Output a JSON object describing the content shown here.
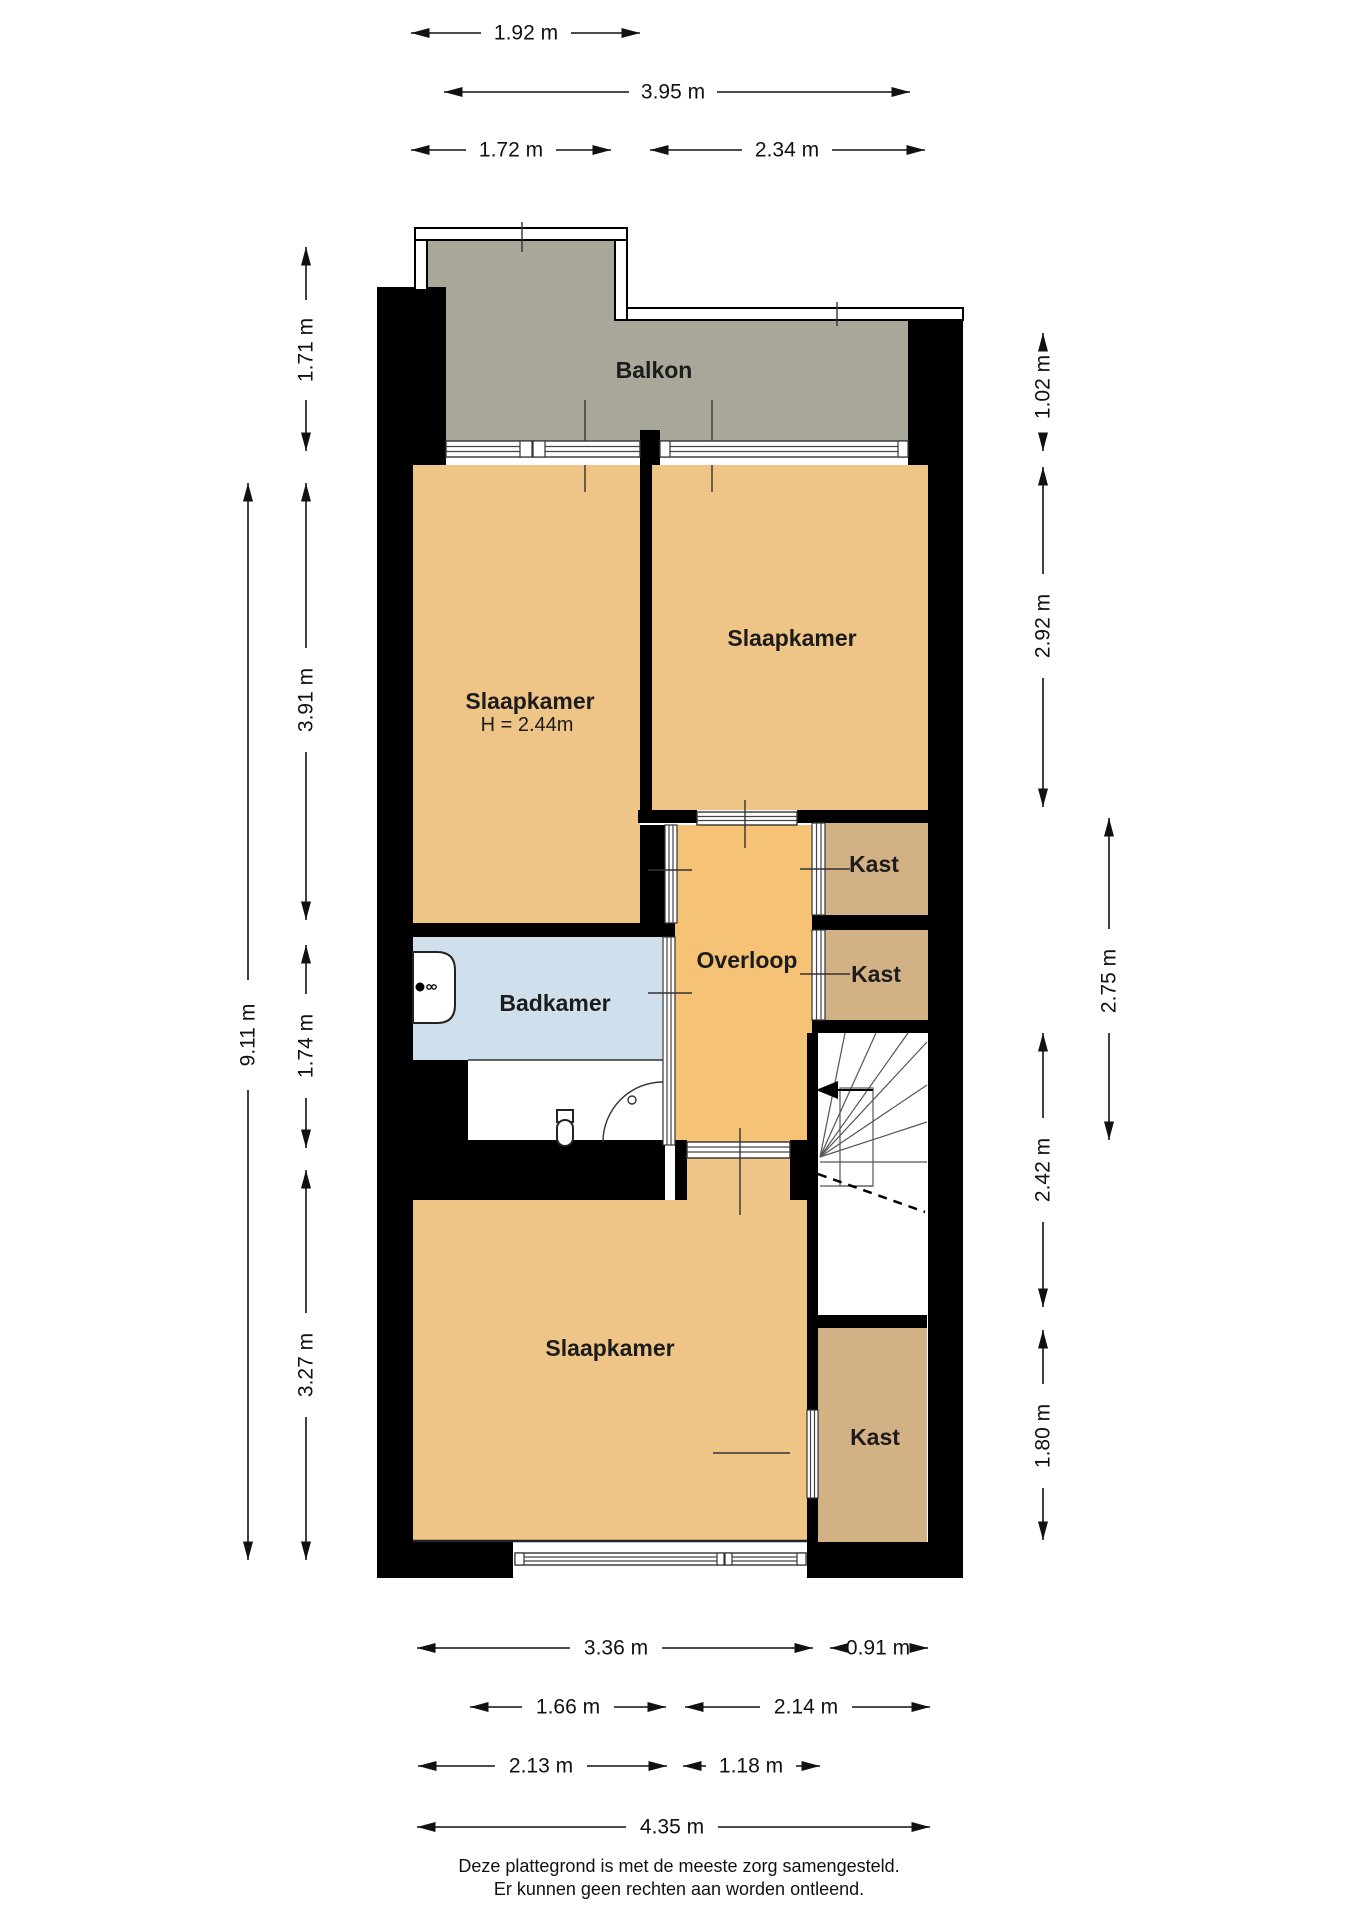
{
  "plan": {
    "rooms": {
      "balkon": {
        "label": "Balkon"
      },
      "bedroom_top_left": {
        "label": "Slaapkamer",
        "height_note": "H = 2.44m"
      },
      "bedroom_top_right": {
        "label": "Slaapkamer"
      },
      "bedroom_bottom": {
        "label": "Slaapkamer"
      },
      "badkamer": {
        "label": "Badkamer"
      },
      "overloop": {
        "label": "Overloop"
      },
      "kast_top": {
        "label": "Kast"
      },
      "kast_middle": {
        "label": "Kast"
      },
      "kast_bottom": {
        "label": "Kast"
      }
    },
    "colors": {
      "wall": "#000000",
      "floor": "#eec487",
      "hall_floor": "#f5c276",
      "closet_floor": "#d2b185",
      "bathroom_floor": "#cfdfeb",
      "balcony_floor": "#a9a79a",
      "background": "#ffffff"
    },
    "dimensions": {
      "top": {
        "balcony_upper_width": "1.92 m",
        "balcony_total_width": "3.95 m",
        "bedroom1_width": "1.72 m",
        "bedroom2_width": "2.34 m"
      },
      "left": {
        "balcony_depth": "1.71 m",
        "total_depth": "9.11 m",
        "bedroom1_depth": "3.91 m",
        "bathroom_depth": "1.74 m",
        "bedroom3_depth": "3.27 m"
      },
      "right": {
        "balcony_side_depth": "1.02 m",
        "bedroom2_depth": "2.92 m",
        "hall_depth": "2.75 m",
        "stairs_depth": "2.42 m",
        "closet_depth": "1.80 m"
      },
      "bottom": {
        "bedroom3_width": "3.36 m",
        "closet_width": "0.91 m",
        "width_166": "1.66 m",
        "width_214": "2.14 m",
        "width_213": "2.13 m",
        "width_118": "1.18 m",
        "total_width": "4.35 m"
      }
    }
  },
  "footer": {
    "line1": "Deze plattegrond is met de meeste zorg samengesteld.",
    "line2": "Er kunnen geen rechten aan worden ontleend."
  }
}
